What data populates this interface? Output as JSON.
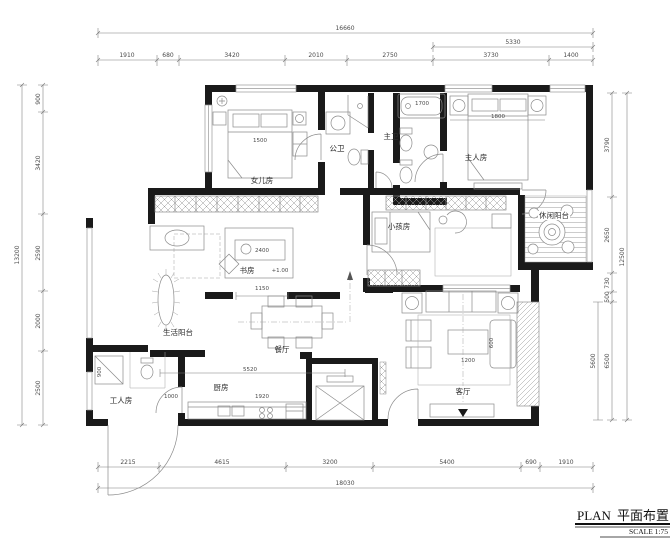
{
  "title": {
    "plan_en": "PLAN",
    "plan_cn": "平面布置图",
    "scale": "SCALE 1:75"
  },
  "rooms": {
    "daughter": "女儿房",
    "guest_bath": "公卫",
    "master_bath": "主卫",
    "master": "主人房",
    "leisure_balcony": "休闲阳台",
    "kids": "小孩房",
    "study": "书房",
    "service_balcony": "生活阳台",
    "dining": "餐厅",
    "kitchen": "厨房",
    "maid": "工人房",
    "living": "客厅"
  },
  "dims": {
    "top_total": "16660",
    "top_sub": "5330",
    "top_segments": [
      "1910",
      "680",
      "3420",
      "2010",
      "2750",
      "3730",
      "1400"
    ],
    "bottom_segments": [
      "2215",
      "4615",
      "3200",
      "5400",
      "690",
      "1910"
    ],
    "bottom_total": "18030",
    "left_segments": [
      "900",
      "3420",
      "2590",
      "2000",
      "2500"
    ],
    "left_total": "13200",
    "right_segments": [
      "3790",
      "2650",
      "730",
      "500",
      "6500"
    ],
    "right_sub": "5600",
    "right_total": "12500"
  },
  "inner_dims": {
    "daughter_bed": "1500",
    "master_bed": "1800",
    "bath_tub": "1700",
    "desk": "2400",
    "study_level": "+1.00",
    "study_opening": "1150",
    "kitchen_span": "5520",
    "kitchen_counter": "1920",
    "hall": "1000",
    "maid_closet": "900",
    "coffee_table_w": "1200",
    "coffee_table_d": "600"
  }
}
